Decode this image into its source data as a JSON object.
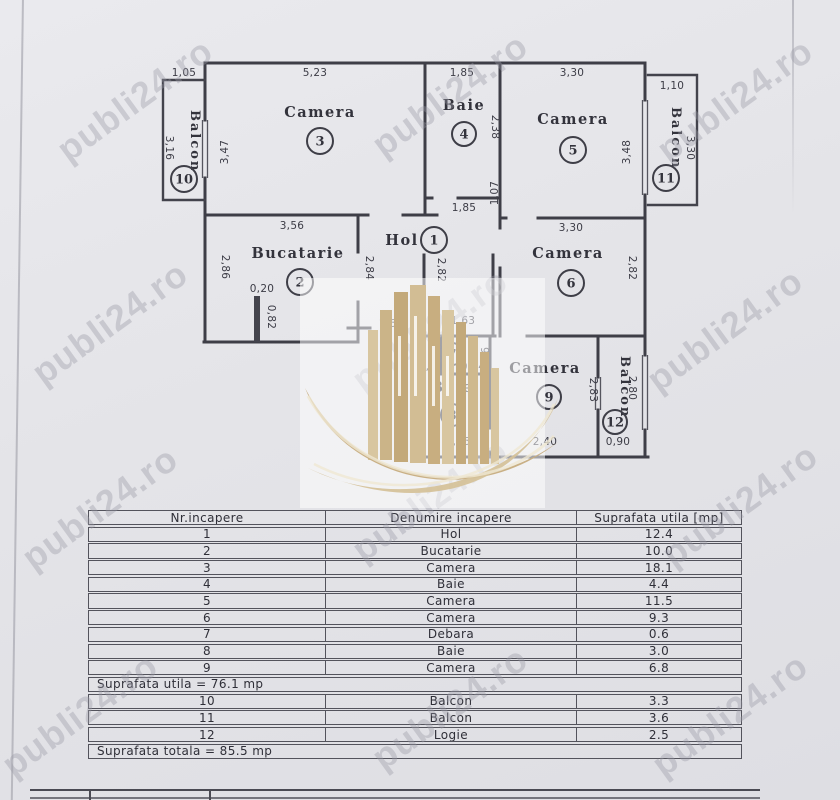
{
  "watermark": {
    "text": "publi24.ro"
  },
  "plan": {
    "rooms": [
      {
        "label": "Camera",
        "num": "3"
      },
      {
        "label": "Baie",
        "num": "4"
      },
      {
        "label": "Camera",
        "num": "5"
      },
      {
        "label": "Bucatarie",
        "num": "2"
      },
      {
        "label": "Hol",
        "num": "1"
      },
      {
        "label": "Camera",
        "num": "6"
      },
      {
        "label": "",
        "num": "7"
      },
      {
        "label": "Baie",
        "num": "8"
      },
      {
        "label": "Camera",
        "num": "9"
      },
      {
        "label": "Balcon",
        "num": "10"
      },
      {
        "label": "Balcon",
        "num": "11"
      },
      {
        "label": "Balcon",
        "num": "12"
      }
    ],
    "dims": {
      "b10w": "1,05",
      "c3w": "5,23",
      "b4w": "1,85",
      "c5w": "3,30",
      "b11w": "1,10",
      "b10h": "3,16",
      "c3h": "3,47",
      "b4h": "2,38",
      "c5h": "3,48",
      "b11h": "3,30",
      "nis": "1,07",
      "holw": "1,85",
      "c5b": "3,30",
      "bucw": "3,56",
      "buch": "2,86",
      "stubw": "0,20",
      "stubh": "0,82",
      "bucr": "2,84",
      "holh": "2,82",
      "c6h": "2,82",
      "hb1": "1,60",
      "hb2": "1,63",
      "d96a": "0,96",
      "d96b": "0,96",
      "d64": "0,64",
      "d94": "0,94",
      "b8h": "1,78",
      "b8w": "1,66",
      "c9w": "2,40",
      "c9h": "2,83",
      "b12h": "2,80",
      "b12w": "0,90"
    }
  },
  "table": {
    "headers": [
      "Nr.incapere",
      "Denumire incapere",
      "Suprafata utila [mp]"
    ],
    "rows": [
      {
        "nr": "1",
        "name": "Hol",
        "area": "12.4"
      },
      {
        "nr": "2",
        "name": "Bucatarie",
        "area": "10.0"
      },
      {
        "nr": "3",
        "name": "Camera",
        "area": "18.1"
      },
      {
        "nr": "4",
        "name": "Baie",
        "area": "4.4"
      },
      {
        "nr": "5",
        "name": "Camera",
        "area": "11.5"
      },
      {
        "nr": "6",
        "name": "Camera",
        "area": "9.3"
      },
      {
        "nr": "7",
        "name": "Debara",
        "area": "0.6"
      },
      {
        "nr": "8",
        "name": "Baie",
        "area": "3.0"
      },
      {
        "nr": "9",
        "name": "Camera",
        "area": "6.8"
      },
      {
        "nr": "10",
        "name": "Balcon",
        "area": "3.3"
      },
      {
        "nr": "11",
        "name": "Balcon",
        "area": "3.6"
      },
      {
        "nr": "12",
        "name": "Logie",
        "area": "2.5"
      }
    ],
    "subtotal": "Suprafata utila = 76.1 mp",
    "total": "Suprafata totala = 85.5 mp"
  }
}
